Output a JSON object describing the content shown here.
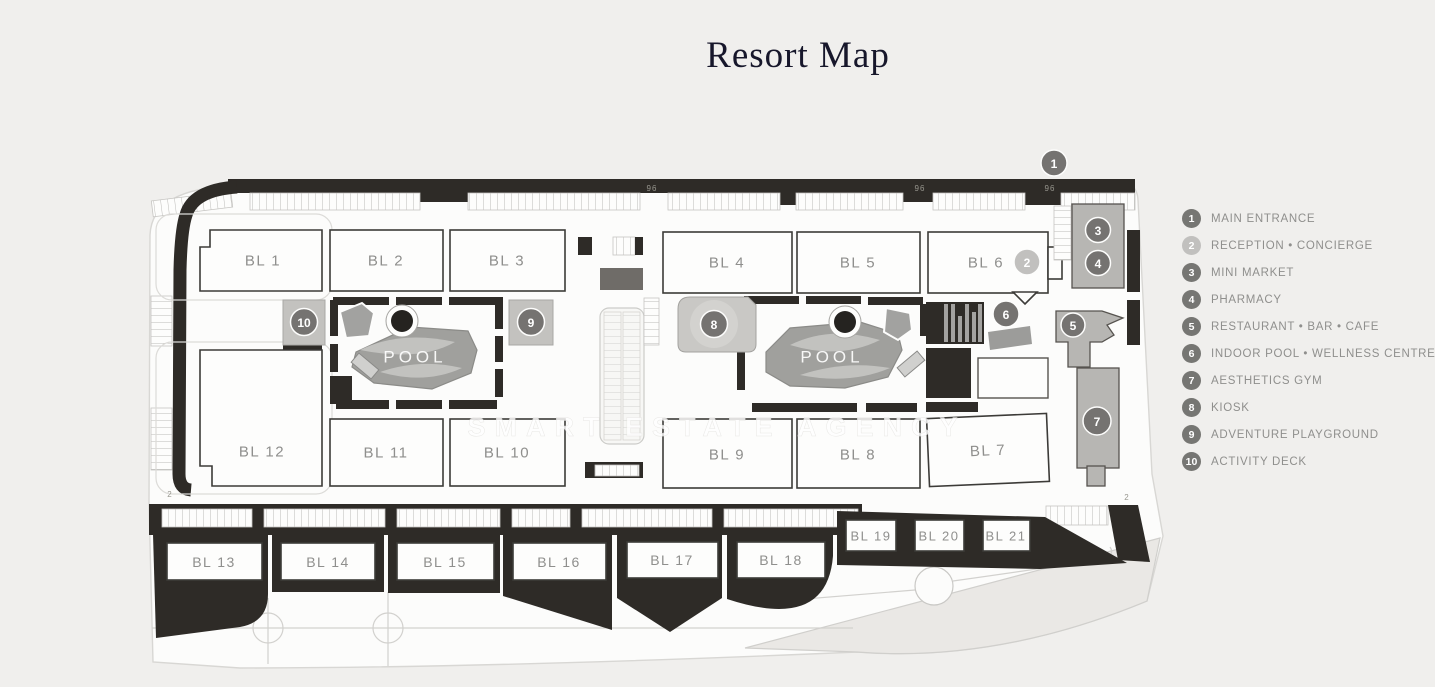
{
  "page": {
    "title": "Resort Map",
    "watermark": "SMART ESTATE AGENCY"
  },
  "legend": {
    "items": [
      {
        "num": "1",
        "label": "MAIN ENTRANCE",
        "variant": "dark"
      },
      {
        "num": "2",
        "label": "RECEPTION • CONCIERGE",
        "variant": "light"
      },
      {
        "num": "3",
        "label": "MINI MARKET",
        "variant": "dark"
      },
      {
        "num": "4",
        "label": "PHARMACY",
        "variant": "dark"
      },
      {
        "num": "5",
        "label": "RESTAURANT • BAR • CAFE",
        "variant": "dark"
      },
      {
        "num": "6",
        "label": "INDOOR POOL • WELLNESS CENTRE",
        "variant": "dark"
      },
      {
        "num": "7",
        "label": "AESTHETICS GYM",
        "variant": "dark"
      },
      {
        "num": "8",
        "label": "KIOSK",
        "variant": "dark"
      },
      {
        "num": "9",
        "label": "ADVENTURE PLAYGROUND",
        "variant": "dark"
      },
      {
        "num": "10",
        "label": "ACTIVITY DECK",
        "variant": "dark"
      }
    ]
  },
  "map": {
    "pool_label": "POOL",
    "blocks": [
      "BL 1",
      "BL 2",
      "BL 3",
      "BL 4",
      "BL 5",
      "BL 6",
      "BL 7",
      "BL 8",
      "BL 9",
      "BL 10",
      "BL 11",
      "BL 12",
      "BL 13",
      "BL 14",
      "BL 15",
      "BL 16",
      "BL 17",
      "BL 18",
      "BL 19",
      "BL 20",
      "BL 21"
    ],
    "deco_marks": {
      "tree_row": "96",
      "tree_single": "2"
    }
  },
  "colors": {
    "background": "#f0efed",
    "map_ground": "#fcfcfb",
    "ink": "#2e2b27",
    "marker_dark": "#757371",
    "marker_light": "#c1c0be",
    "label_gray": "#8f8f8d",
    "pool": "#a0a09d",
    "beach": "#eae8e5"
  }
}
